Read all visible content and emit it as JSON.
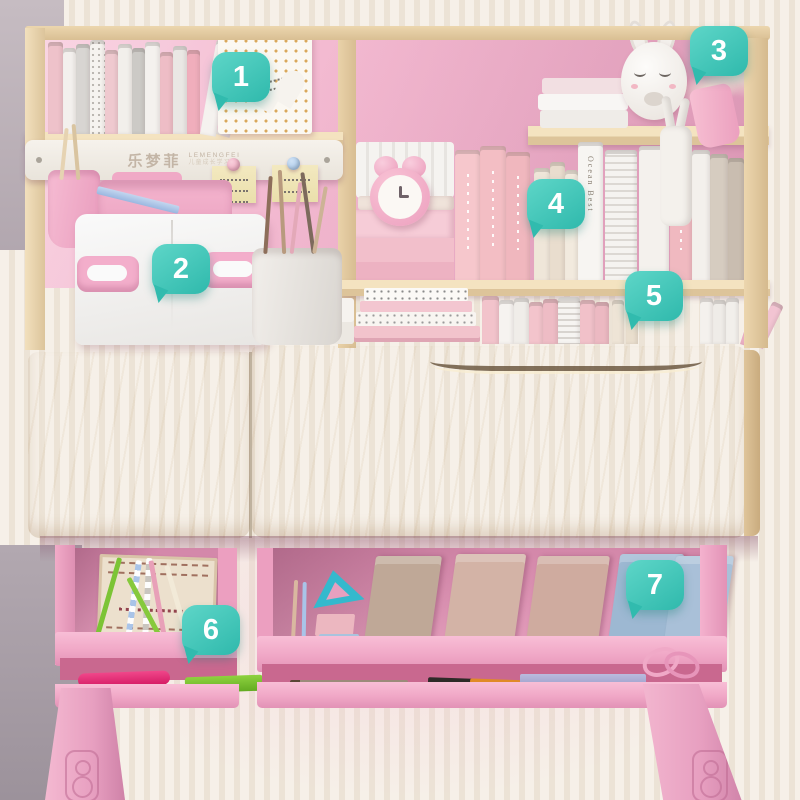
{
  "callouts": [
    {
      "label": "1"
    },
    {
      "label": "2"
    },
    {
      "label": "3"
    },
    {
      "label": "4"
    },
    {
      "label": "5"
    },
    {
      "label": "6"
    },
    {
      "label": "7"
    }
  ],
  "brand": {
    "name_cn": "乐梦菲",
    "name_en": "LEMENGFEI",
    "tagline": "儿童成长学习桌"
  },
  "books": {
    "white_spine_text": "Ocean Best"
  },
  "colors": {
    "callout_teal": "#3ec6b9",
    "hutch_back_pink": "#f2b7cf",
    "drawer_pink": "#f0a7c6",
    "desk_wood": "#eed9b2",
    "wall_stripe": "#ece3d6"
  }
}
